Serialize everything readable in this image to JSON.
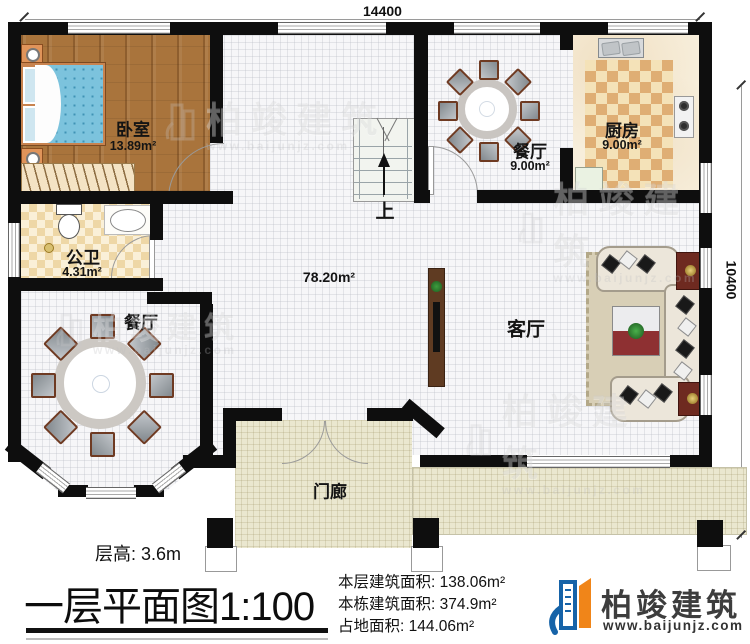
{
  "dimensions": {
    "top": "14400",
    "right": "10400"
  },
  "rooms": {
    "bedroom": {
      "label": "卧室",
      "area": "13.89m²"
    },
    "bathroom": {
      "label": "公卫",
      "area": "4.31m²"
    },
    "dining_top": {
      "label": "餐厅",
      "area": "9.00m²"
    },
    "kitchen": {
      "label": "厨房",
      "area": "9.00m²"
    },
    "hall": {
      "area": "78.20m²"
    },
    "living": {
      "label": "客厅"
    },
    "dining_bay": {
      "label": "餐厅"
    },
    "porch": {
      "label": "门廊"
    }
  },
  "stairs": {
    "up_label": "上"
  },
  "watermark": {
    "name": "柏竣建筑",
    "url": "www.baijunjz.com"
  },
  "footer": {
    "floor_height": "层高: 3.6m",
    "title": "一层平面图",
    "scale": "1:100",
    "stats": [
      {
        "label": "本层建筑面积:",
        "value": "138.06m²"
      },
      {
        "label": "本栋建筑面积:",
        "value": "374.9m²"
      },
      {
        "label": "占地面积:",
        "value": "144.06m²"
      }
    ],
    "brand": {
      "name": "柏竣建筑",
      "url": "www.baijunjz.com"
    }
  },
  "colors": {
    "wall": "#0e0e0e",
    "wood_floor": "#a9743c",
    "checker_tan": "#dfae74",
    "grid_floor": "#f6f6f8",
    "porch_tile": "#eae7cf",
    "brand_blue": "#1663a8",
    "brand_orange": "#f08519"
  }
}
